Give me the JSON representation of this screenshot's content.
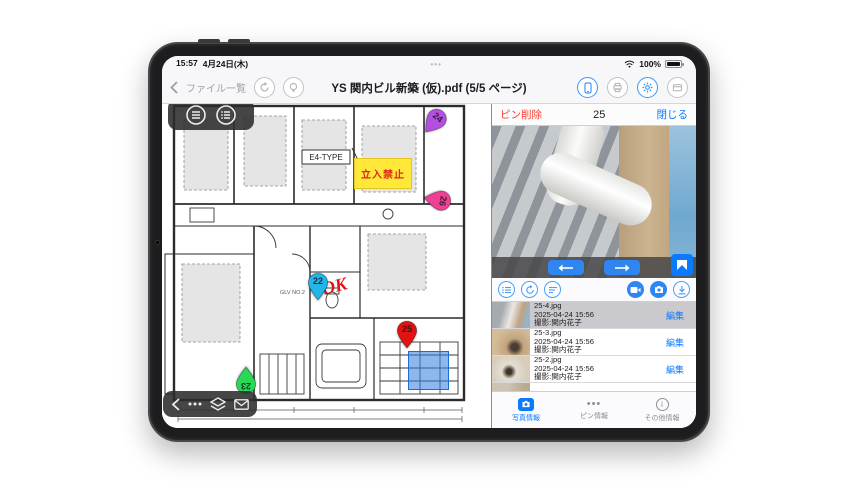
{
  "colors": {
    "accent": "#0a7aff",
    "destructive": "#ff3b30",
    "keepout_bg": "#ffe83a",
    "highlight_blue": "#2d7de1",
    "selected_row_bg": "#c9c9ce"
  },
  "status_bar": {
    "time": "15:57",
    "date": "4月24日(木)",
    "dots": "•••",
    "battery_percent": "100%"
  },
  "nav_bar": {
    "back_label": "ファイル一覧",
    "title": "YS 関内ビル新築 (仮).pdf (5/5 ページ)"
  },
  "plan": {
    "type_label": "E4-TYPE",
    "room_label": "GLV NO.2",
    "keepout_label": "立入禁止",
    "ok_annotation": "OK",
    "pins": [
      {
        "label": "24",
        "color": "#b44fe0"
      },
      {
        "label": "26",
        "color": "#ef3f96"
      },
      {
        "label": "22",
        "color": "#21b5ea"
      },
      {
        "label": "25",
        "color": "#e31212"
      },
      {
        "label": "23",
        "color": "#27d957"
      }
    ]
  },
  "pin_panel": {
    "delete_label": "ピン削除",
    "pin_number": "25",
    "close_label": "閉じる"
  },
  "photo_list": {
    "items": [
      {
        "filename": "25-4.jpg",
        "datetime": "2025-04-24 15:56",
        "photographer": "撮影:関内花子",
        "edit_label": "編集"
      },
      {
        "filename": "25-3.jpg",
        "datetime": "2025-04-24 15:56",
        "photographer": "撮影:関内花子",
        "edit_label": "編集"
      },
      {
        "filename": "25-2.jpg",
        "datetime": "2025-04-24 15:56",
        "photographer": "撮影:関内花子",
        "edit_label": "編集"
      },
      {
        "filename": "25-1.jpg"
      }
    ]
  },
  "tab_bar": {
    "tabs": [
      {
        "label": "写真情報"
      },
      {
        "label": "ピン情報"
      },
      {
        "label": "その他情報"
      }
    ]
  }
}
